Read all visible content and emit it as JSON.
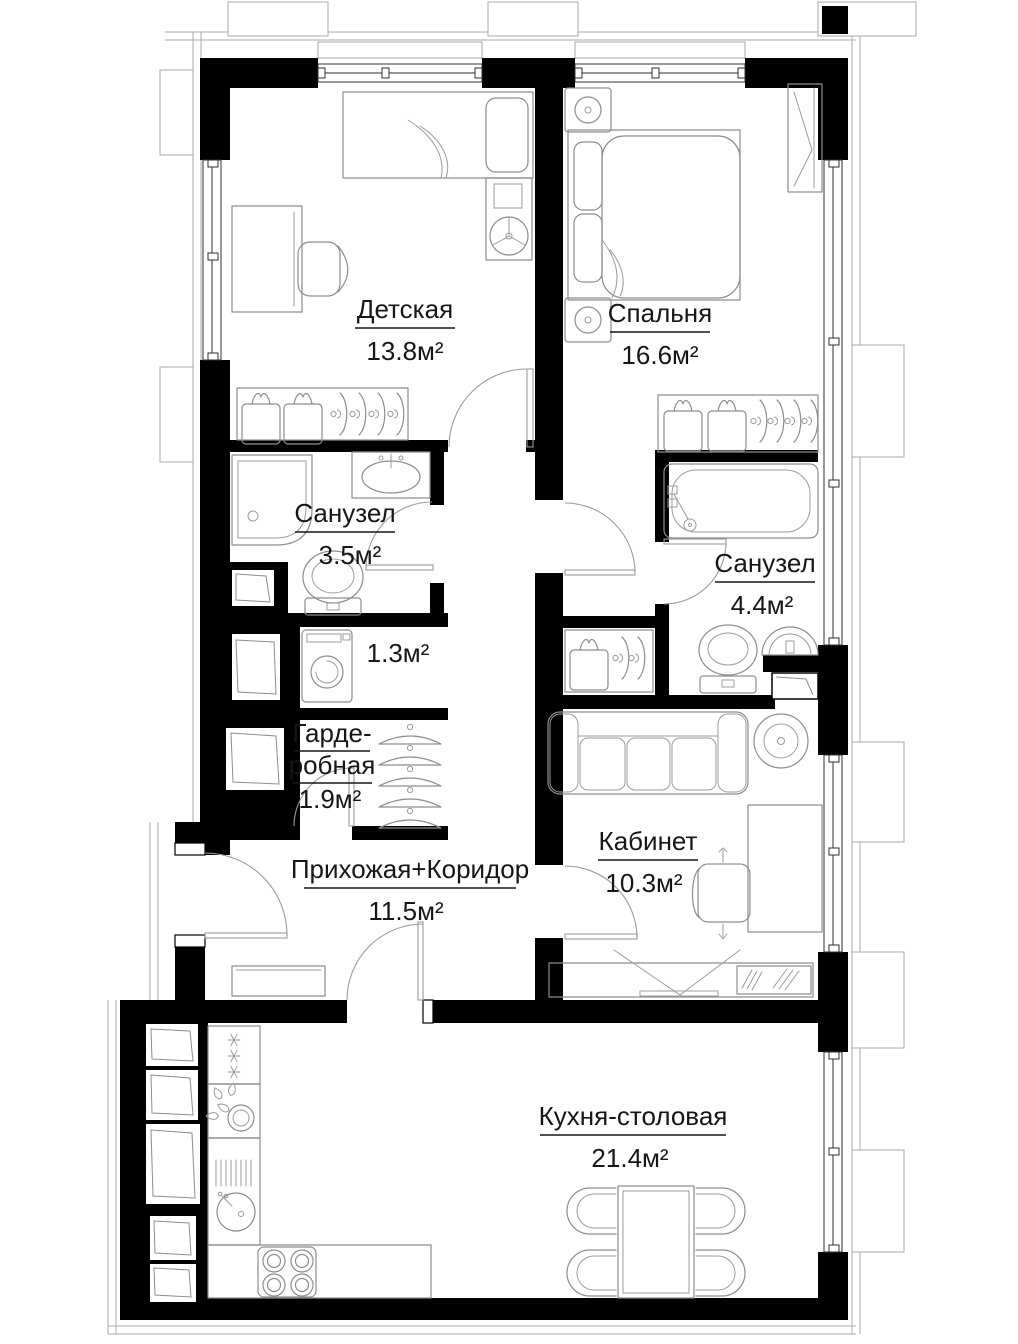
{
  "plan": {
    "type": "apartment-floor-plan",
    "language": "ru",
    "area_unit": "м²",
    "rooms": [
      {
        "id": "children-room",
        "name": "Детская",
        "area": "13.8м²"
      },
      {
        "id": "bedroom",
        "name": "Спальня",
        "area": "16.6м²"
      },
      {
        "id": "bathroom-small",
        "name": "Санузел",
        "area": "3.5м²"
      },
      {
        "id": "bathroom-master",
        "name": "Санузел",
        "area": "4.4м²"
      },
      {
        "id": "laundry-niche",
        "name": "",
        "area": "1.3м²"
      },
      {
        "id": "walk-in-closet",
        "name": "Гардеробная",
        "name_line1": "Гарде-",
        "name_line2": "робная",
        "area": "1.9м²"
      },
      {
        "id": "hallway",
        "name": "Прихожая+Коридор",
        "area": "11.5м²"
      },
      {
        "id": "office",
        "name": "Кабинет",
        "area": "10.3м²"
      },
      {
        "id": "kitchen-dining",
        "name": "Кухня-столовая",
        "area": "21.4м²"
      }
    ],
    "colors": {
      "walls": "#000000",
      "furniture_stroke": "#8d8d8d",
      "labels": "#161616",
      "facade": "#a9a9a9",
      "background": "#ffffff"
    },
    "furniture_icons": [
      "single-bed-icon",
      "double-bed-icon",
      "desk-icon",
      "chair-icon",
      "office-chair-icon",
      "nightstand-icon",
      "wardrobe-icon",
      "hanger-icon",
      "folded-clothes-icon",
      "shower-icon",
      "toilet-icon",
      "washbasin-icon",
      "bathtub-icon",
      "washing-machine-icon",
      "sofa-icon",
      "plant-icon",
      "tv-stand-icon",
      "console-icon",
      "fridge-icon",
      "kitchen-sink-icon",
      "stove-icon",
      "dining-table-icon",
      "dining-chair-icon",
      "duct-shaft-icon",
      "window-icon",
      "door-icon"
    ]
  }
}
